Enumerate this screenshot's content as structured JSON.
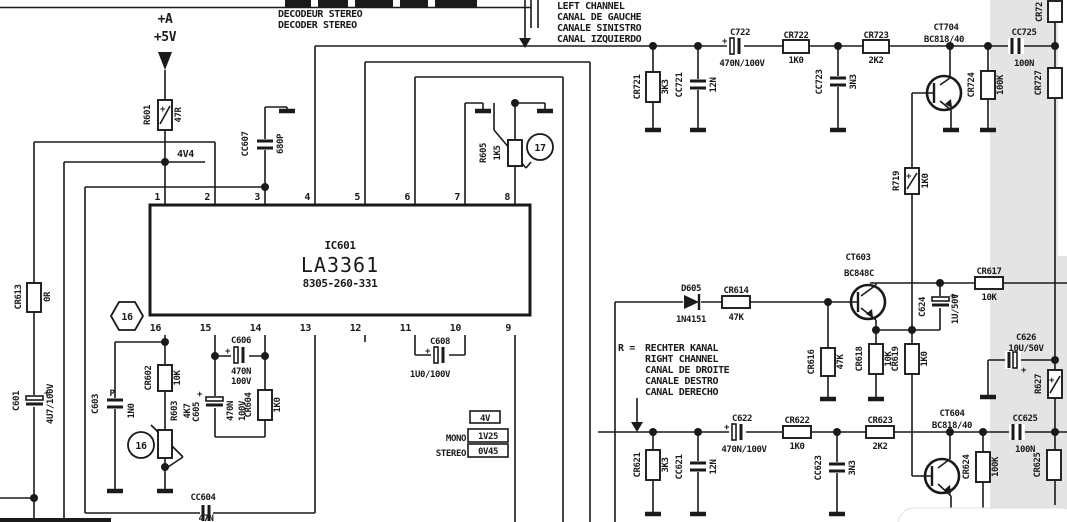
{
  "title_block": {
    "line1": "DECODEUR STEREO",
    "line2": "DECODER STEREO"
  },
  "supply": {
    "net": "+A",
    "voltage": "+5V",
    "node": "4V4"
  },
  "left_channel_note": [
    "LEFT CHANNEL",
    "CANAL DE GAUCHE",
    "CANALE SINISTRO",
    "CANAL IZQUIERDO"
  ],
  "right_channel_note": {
    "prefix": "R =",
    "lines": [
      "RECHTER KANAL",
      "RIGHT CHANNEL",
      "CANAL DE DROITE",
      "CANALE DESTRO",
      "CANAL DERECHO"
    ]
  },
  "ic": {
    "ref": "IC601",
    "part": "LA3361",
    "code": "8305-260-331",
    "pins_top": [
      "1",
      "2",
      "3",
      "4",
      "5",
      "6",
      "7",
      "8"
    ],
    "pins_bottom": [
      "16",
      "15",
      "14",
      "13",
      "12",
      "11",
      "10",
      "9"
    ]
  },
  "callouts": {
    "hex16": "16",
    "circle16": "16",
    "circle17": "17"
  },
  "measurements": {
    "idle": "4V",
    "mono_label": "MONO",
    "mono_value": "1V25",
    "stereo_label": "STEREO",
    "stereo_value": "0V45"
  },
  "sym": {
    "plus": "+"
  },
  "components": {
    "r601": {
      "ref": "R601",
      "value": "47R"
    },
    "cc607": {
      "ref": "CC607",
      "value": "680P"
    },
    "r605": {
      "ref": "R605",
      "value": "1K5"
    },
    "cr613": {
      "ref": "CR613",
      "value": "0R"
    },
    "c601": {
      "ref": "C601",
      "value": "4U7/100V"
    },
    "c603": {
      "ref": "C603",
      "value": "1N0",
      "mark": "P"
    },
    "cr602": {
      "ref": "CR602",
      "value": "10K"
    },
    "r603": {
      "ref": "R603",
      "value": "4K7"
    },
    "c605": {
      "ref": "C605",
      "value": "470N",
      "value2": "100V"
    },
    "cr604": {
      "ref": "CR604",
      "value": "1K0"
    },
    "c606": {
      "ref": "C606",
      "value": "470N",
      "value2": "100V"
    },
    "cc604": {
      "ref": "CC604",
      "value": "47N"
    },
    "c608": {
      "ref": "C608",
      "value": "1U0/100V"
    },
    "cr721": {
      "ref": "CR721",
      "value": "3K3"
    },
    "cc721": {
      "ref": "CC721",
      "value": "12N"
    },
    "c722": {
      "ref": "C722",
      "value": "470N/100V"
    },
    "cr722": {
      "ref": "CR722",
      "value": "1K0"
    },
    "cc723": {
      "ref": "CC723",
      "value": "3N3"
    },
    "cr723": {
      "ref": "CR723",
      "value": "2K2"
    },
    "ct704": {
      "ref": "CT704",
      "value": "BC818/40"
    },
    "r719": {
      "ref": "R719",
      "value": "1K0"
    },
    "cr724": {
      "ref": "CR724",
      "value": "100K"
    },
    "cc725": {
      "ref": "CC725",
      "value": "100N"
    },
    "cr72x": {
      "ref": "CR72"
    },
    "cr727": {
      "ref": "CR727"
    },
    "d605": {
      "ref": "D605",
      "value": "1N4151"
    },
    "cr614": {
      "ref": "CR614",
      "value": "47K"
    },
    "ct603": {
      "ref": "CT603",
      "value": "BC848C"
    },
    "cr616": {
      "ref": "CR616",
      "value": "47K"
    },
    "cr618": {
      "ref": "CR618",
      "value": "10K"
    },
    "cr619": {
      "ref": "CR619",
      "value": "1K0"
    },
    "c624": {
      "ref": "C624",
      "value": "1U/50V"
    },
    "cr617": {
      "ref": "CR617",
      "value": "10K"
    },
    "c626": {
      "ref": "C626",
      "value": "10U/50V"
    },
    "r627": {
      "ref": "R627"
    },
    "cr621": {
      "ref": "CR621",
      "value": "3K3"
    },
    "cc621": {
      "ref": "CC621",
      "value": "12N"
    },
    "c622": {
      "ref": "C622",
      "value": "470N/100V"
    },
    "cr622": {
      "ref": "CR622",
      "value": "1K0"
    },
    "cc623": {
      "ref": "CC623",
      "value": "3N3"
    },
    "cr623": {
      "ref": "CR623",
      "value": "2K2"
    },
    "ct604": {
      "ref": "CT604",
      "value": "BC818/40"
    },
    "cr624": {
      "ref": "CR624",
      "value": "100K"
    },
    "cc625": {
      "ref": "CC625",
      "value": "100N"
    },
    "cr625": {
      "ref": "CR625"
    }
  },
  "colors": {
    "ink": "#1a1a1a",
    "paper": "#ffffff",
    "shaded_region": "#e4e4e4"
  }
}
